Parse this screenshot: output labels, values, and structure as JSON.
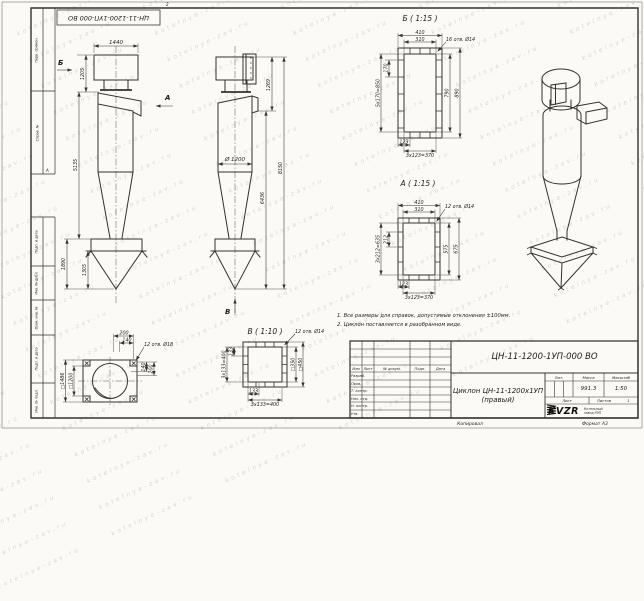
{
  "sheet": {
    "stamp": "ЦН-11-1200-1УП-000 ВО",
    "zone_top": "2",
    "zone_left": "А",
    "watermark": "kotelnye-zav.ru",
    "footer": {
      "copied": "Копировал",
      "format": "Формат А3"
    },
    "margin": {
      "m1": "Перв. примен.",
      "m2": "Справ. №",
      "m3": "Подп. и дата",
      "m4": "Инв. № дубл.",
      "m5": "Взам. инв. №",
      "m6": "Подп. и дата",
      "m7": "Инв. № подл."
    }
  },
  "notes": {
    "line1": "1. Все размеры для справок, допустимые отклонения ±100мм.",
    "line2": "2. Циклон поставляется в разобранном виде."
  },
  "views": {
    "front": {
      "dim_width_top": "1440",
      "dim_top_h": "1205",
      "dim_body_h": "5135",
      "dim_bunker_h": "1890",
      "dim_cone_h": "1305",
      "arrow_b": "Б",
      "arrow_a": "А"
    },
    "side": {
      "dim_outlet_h": "1269",
      "dim_diameter": "Ø 1200",
      "dim_lower_h": "6436",
      "dim_total_h": "8150",
      "arrow_v": "В"
    },
    "section_b": {
      "title": "Б ( 1:15 )",
      "holes": "16 отв. Ø14",
      "dim_out_w": "410",
      "dim_in_w": "310",
      "dim_pitch": "170",
      "dim_pitch_total": "5х170=850",
      "dim_in_h": "790",
      "dim_out_h": "890",
      "dim_bottom": "123",
      "dim_bottom_total": "3х123=370"
    },
    "section_a": {
      "title": "А ( 1:15 )",
      "holes": "12 отв. Ø14",
      "dim_out_w": "410",
      "dim_in_w": "310",
      "dim_pitch": "212",
      "dim_pitch_total": "3х212=635",
      "dim_in_h": "575",
      "dim_out_h": "675",
      "dim_bottom": "123",
      "dim_bottom_total": "3х123=370"
    },
    "section_v": {
      "title": "В ( 1:10 )",
      "holes": "12 отв. Ø14",
      "dim_left": "133",
      "dim_left_total": "3х133=400",
      "dim_sq_in": "□350",
      "dim_sq_out": "□450",
      "dim_bottom": "133",
      "dim_bottom_total": "3х133=400"
    },
    "top_view": {
      "holes": "12 отв. Ø18",
      "dim_t1": "200",
      "dim_t2": "140",
      "dim_r1": "140",
      "dim_r2": "200",
      "dim_sq_out": "□1486",
      "dim_sq_in": "□1200"
    }
  },
  "title_block": {
    "designation": "ЦН-11-1200-1УП-000 ВО",
    "name_line1": "Циклон ЦН-11-1200х1УП",
    "name_line2": "(правый)",
    "cols": {
      "izm": "Изм",
      "list": "Лист",
      "doc": "№ докум.",
      "podp": "Подп.",
      "data": "Дата"
    },
    "rows": {
      "r1": "Разраб.",
      "r2": "Пров.",
      "r3": "Т. контр.",
      "r4": "Нач. отд.",
      "r5": "Н. контр.",
      "r6": "Утв."
    },
    "lit_label": "Лит.",
    "mass_label": "Масса",
    "scale_label": "Масштаб",
    "mass_value": "991.3",
    "scale_value": "1:50",
    "sheet_label": "Лист",
    "sheets_label": "Листов",
    "sheets_value": "1",
    "logo_text": "KVZR",
    "company_line1": "Котельный",
    "company_line2": "завод РЭП"
  }
}
